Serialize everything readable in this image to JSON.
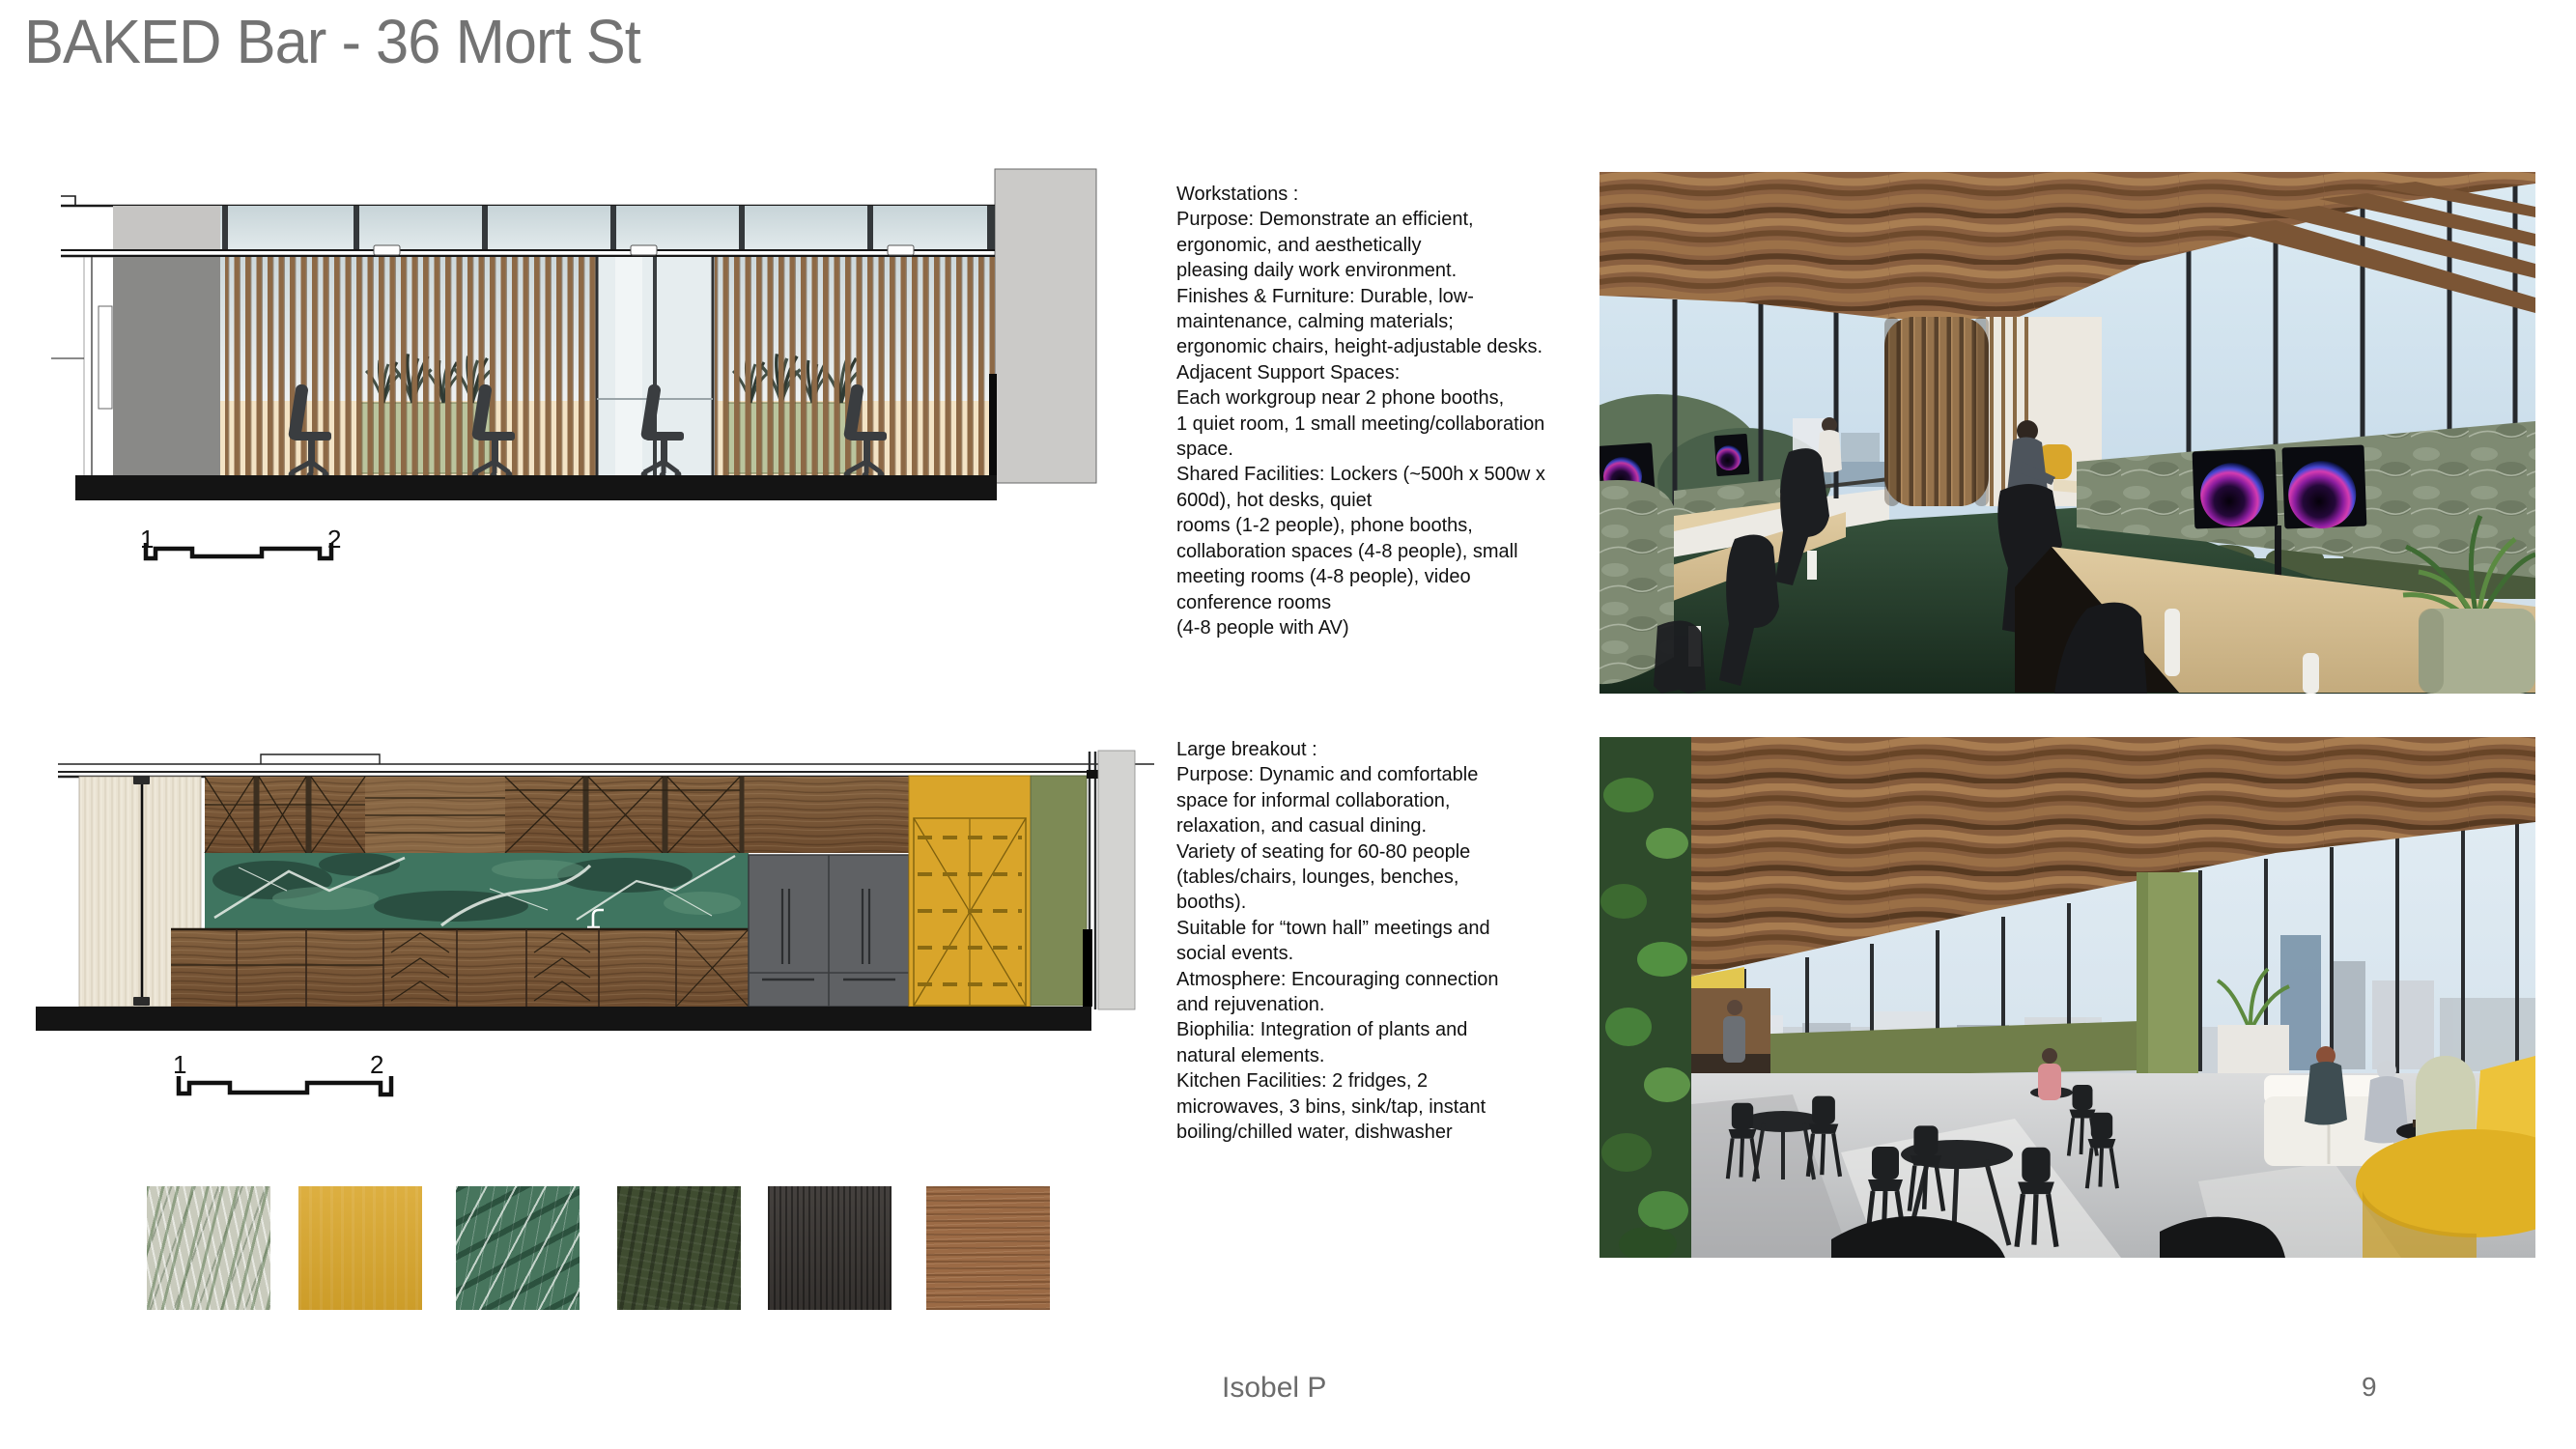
{
  "slide": {
    "title": "BAKED Bar - 36 Mort St",
    "footer": {
      "author": "Isobel P",
      "page_number": "9"
    }
  },
  "sections": [
    {
      "id": "workstations",
      "heading": "Workstations :",
      "body": "Purpose: Demonstrate an efficient,\nergonomic, and aesthetically\npleasing daily work environment.\nFinishes & Furniture: Durable, low-\nmaintenance, calming materials;\nergonomic chairs, height-adjustable desks.\nAdjacent Support Spaces:\nEach workgroup near 2 phone booths,\n1 quiet room, 1 small meeting/collaboration\nspace.\nShared Facilities: Lockers (~500h x 500w x\n600d), hot desks, quiet\nrooms (1-2 people), phone booths,\ncollaboration spaces (4-8 people), small\nmeeting rooms (4-8 people), video\nconference rooms\n(4-8 people with AV)"
    },
    {
      "id": "large-breakout",
      "heading": "Large breakout :",
      "body": "Purpose: Dynamic and comfortable\nspace for informal collaboration,\nrelaxation, and casual dining.\nVariety of seating for 60-80 people\n(tables/chairs, lounges, benches,\nbooths).\nSuitable for “town hall” meetings and\nsocial events.\nAtmosphere: Encouraging connection\nand rejuvenation.\nBiophilia: Integration of plants and\nnatural elements.\nKitchen Facilities: 2 fridges, 2\nmicrowaves, 3 bins, sink/tap, instant\nboiling/chilled water, dishwasher"
    }
  ],
  "drawings": [
    {
      "name": "workstation-section-elevation",
      "scale_labels": [
        "1",
        "2"
      ]
    },
    {
      "name": "breakout-kitchen-elevation",
      "scale_labels": [
        "1",
        "2"
      ]
    }
  ],
  "materials": [
    {
      "name": "sage-speckled-fabric",
      "color": "#c9cbbd"
    },
    {
      "name": "mustard-laminate",
      "color": "#d9a62b"
    },
    {
      "name": "green-marble",
      "color": "#47755d"
    },
    {
      "name": "olive-green-fabric",
      "color": "#3f4c30"
    },
    {
      "name": "charcoal-timber",
      "color": "#3b3734"
    },
    {
      "name": "walnut-timber",
      "color": "#9b6a45"
    }
  ],
  "photos": [
    {
      "name": "workstations-interior-render"
    },
    {
      "name": "large-breakout-interior-render"
    }
  ]
}
